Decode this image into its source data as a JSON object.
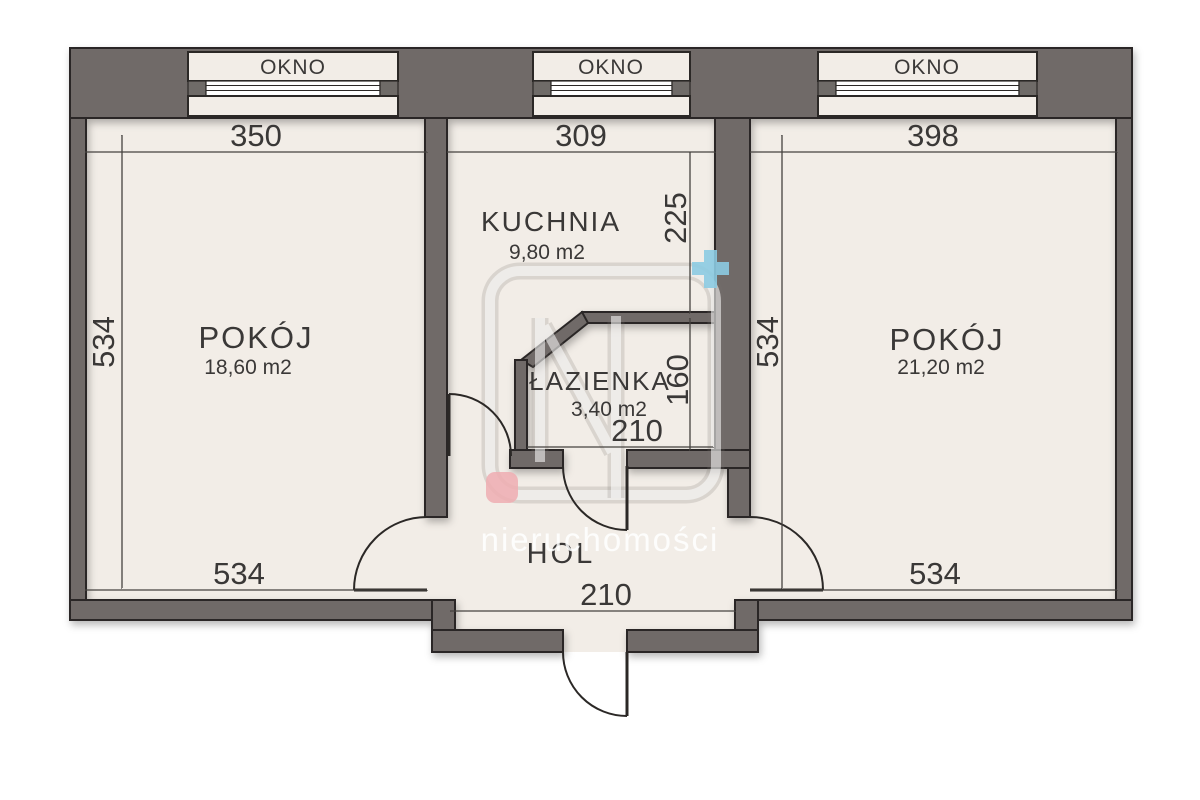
{
  "title": "Rzut mieszkania",
  "colors": {
    "background": "#ffffff",
    "wall": "#6f6b68",
    "wall_outline": "#2b2826",
    "floor": "#f2ede7",
    "dim_line": "#45423f",
    "text": "#3a3837",
    "watermark_blue": "#8ccbe2",
    "watermark_pink": "#efadb2",
    "watermark_white": "rgba(255,255,255,0.55)"
  },
  "windows": [
    {
      "label": "OKNO"
    },
    {
      "label": "OKNO"
    },
    {
      "label": "OKNO"
    }
  ],
  "rooms": [
    {
      "name": "POKÓJ",
      "area": "18,60 m2"
    },
    {
      "name": "KUCHNIA",
      "area": "9,80 m2"
    },
    {
      "name": "ŁAZIENKA",
      "area": "3,40 m2"
    },
    {
      "name": "POKÓJ",
      "area": "21,20 m2"
    },
    {
      "name": "HOL"
    }
  ],
  "dims": {
    "pokoj_left_width": "350",
    "kuchnia_width": "309",
    "pokoj_right_width": "398",
    "left_height": "534",
    "kuchnia_depth": "225",
    "lazienka_depth": "160",
    "lazienka_width": "210",
    "right_height": "534",
    "pokoj_left_bottom": "534",
    "pokoj_right_bottom": "534",
    "hol_width": "210"
  },
  "watermark": {
    "brand": "nieruchomości"
  }
}
